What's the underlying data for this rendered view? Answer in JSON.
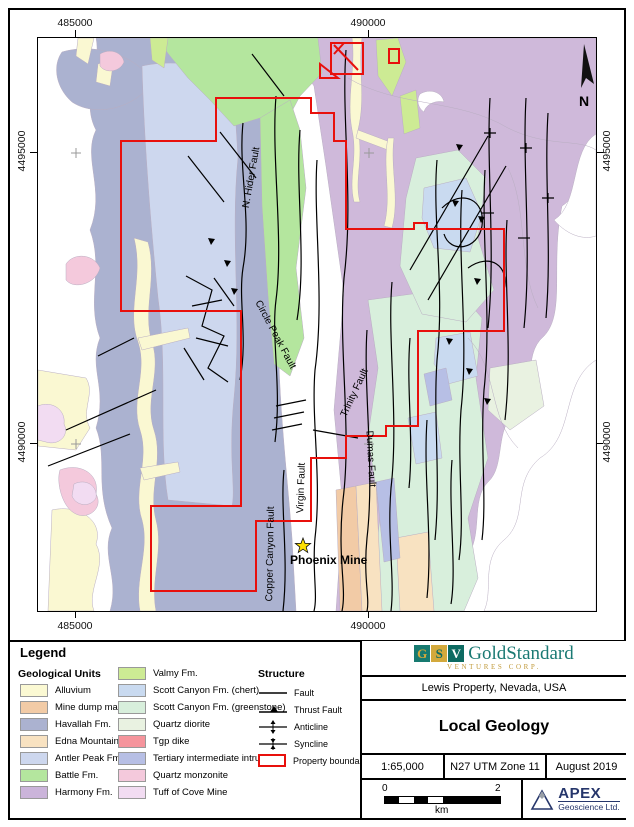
{
  "map": {
    "coords": {
      "top": [
        "485000",
        "490000"
      ],
      "bottom": [
        "485000",
        "490000"
      ],
      "left": [
        "4495000",
        "4490000"
      ],
      "right": [
        "4495000",
        "4490000"
      ]
    },
    "labels": {
      "n_hider_fault": "N. Hider Fault",
      "circle_peak_fault": "Circle Peak Fault",
      "trinity_fault": "Trinity Fault",
      "dumas_fault": "Dumas Fault",
      "virgin_fault": "Virgin Fault",
      "copper_canyon_fault": "Copper Canyon Fault",
      "phoenix_mine": "Phoenix Mine",
      "north": "N"
    }
  },
  "legend": {
    "title": "Legend",
    "geological_units_title": "Geological Units",
    "units": [
      {
        "label": "Alluvium",
        "color": "#fbf9d3"
      },
      {
        "label": "Mine dump material",
        "color": "#f2cba6"
      },
      {
        "label": "Havallah Fm.",
        "color": "#abb2d0"
      },
      {
        "label": "Edna Mountain Fm.",
        "color": "#f8e2c1"
      },
      {
        "label": "Antler Peak Fm.",
        "color": "#cdd7ee"
      },
      {
        "label": "Battle Fm.",
        "color": "#b4e69e"
      },
      {
        "label": "Harmony Fm.",
        "color": "#cbb4da"
      },
      {
        "label": "Valmy Fm.",
        "color": "#cdeb94"
      },
      {
        "label": "Scott Canyon Fm. (chert)",
        "color": "#c9daf0"
      },
      {
        "label": "Scott Canyon Fm. (greenstone)",
        "color": "#d8efdc"
      },
      {
        "label": "Quartz diorite",
        "color": "#e9f2e1"
      },
      {
        "label": "Tgp dike",
        "color": "#f5949c"
      },
      {
        "label": "Tertiary intermediate intrusive",
        "color": "#b7bfe5"
      },
      {
        "label": "Quartz monzonite",
        "color": "#f4c9dc"
      },
      {
        "label": "Tuff of Cove Mine",
        "color": "#f2dcf2"
      }
    ],
    "structure_title": "Structure",
    "structure_items": [
      {
        "label": "Fault"
      },
      {
        "label": "Thrust Fault"
      },
      {
        "label": "Anticline"
      },
      {
        "label": "Syncline"
      },
      {
        "label": "Property boundary"
      }
    ],
    "property_boundary_color": "#e8100c"
  },
  "title_block": {
    "logo": {
      "g": "G",
      "s": "S",
      "v": "V",
      "name": "GoldStandard",
      "subtitle": "VENTURES CORP."
    },
    "property": "Lewis Property, Nevada, USA",
    "title": "Local Geology",
    "scale": "1:65,000",
    "projection": "N27 UTM Zone 11",
    "date": "August 2019",
    "scalebar": {
      "start": "0",
      "end": "2",
      "unit": "km"
    },
    "apex": {
      "name": "APEX",
      "sub": "Geoscience Ltd."
    }
  }
}
